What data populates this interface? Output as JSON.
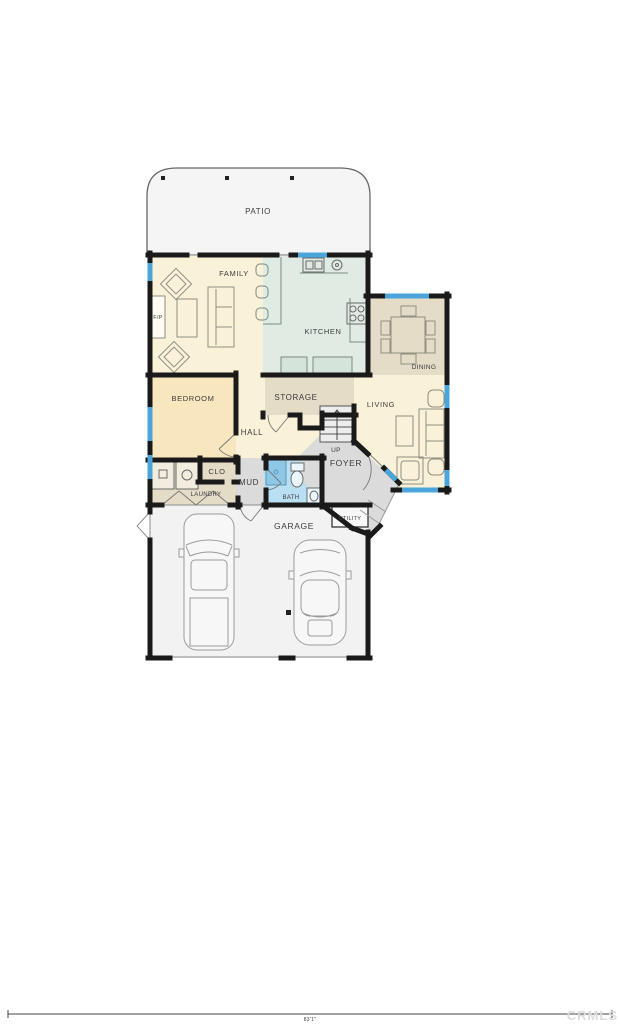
{
  "plan": {
    "rooms": {
      "patio": "PATIO",
      "family": "FAMILY",
      "fireplace": "F/P",
      "kitchen": "KITCHEN",
      "dining": "DINING",
      "bedroom": "BEDROOM",
      "storage": "STORAGE",
      "hall": "HALL",
      "up": "UP",
      "foyer": "FOYER",
      "living": "LIVING",
      "clo": "CLO",
      "laundry": "LAUNDRY",
      "mud": "MUD",
      "bath": "BATH",
      "garage": "GARAGE",
      "utility": "UTILITY"
    },
    "scale_bar": {
      "length_label": "83'1\""
    },
    "watermark": "CRMLS",
    "colors": {
      "wall": "#1A1A1A",
      "window": "#4BA5DA",
      "cream": "#FAF1D9",
      "bedroom": "#F8E7BE",
      "kitchen": "#E0EBE3",
      "counter": "#D4E4DA",
      "tan": "#E5DCC7",
      "gray": "#DBDBDB",
      "bath": "#BBDFF2",
      "shower": "#8FC7E7",
      "garage": "#F2F2F2",
      "patio": "#F5F5F5",
      "label": "#3C3C3C"
    }
  }
}
